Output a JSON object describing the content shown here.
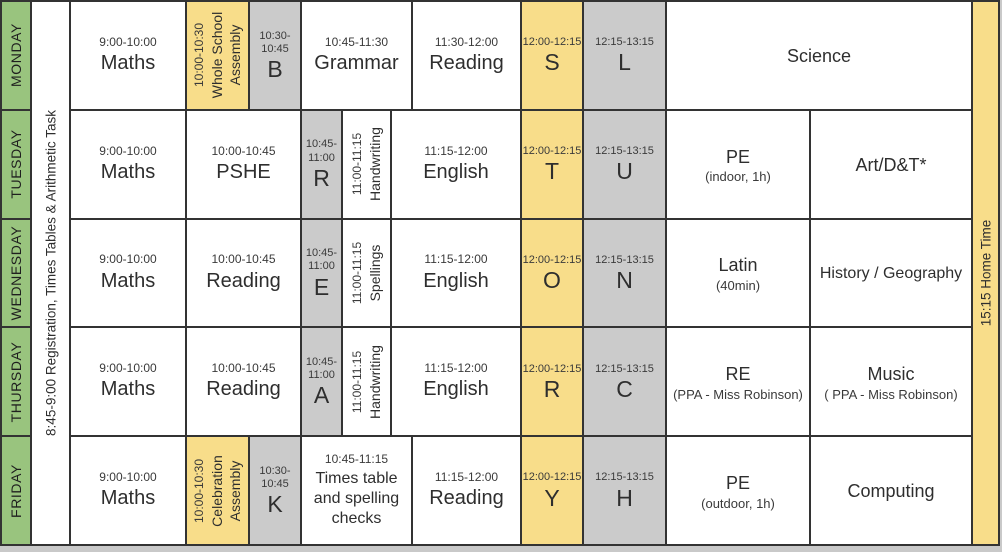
{
  "colors": {
    "green": "#99c47e",
    "yellow": "#f8dd8a",
    "gray": "#cbcbcb",
    "white": "#ffffff",
    "line": "#333333",
    "page_background": "#c9c9c9"
  },
  "registration_label": "8:45-9:00 Registration, Times Tables & Arithmetic Task",
  "home_time_label": "15:15 Home Time",
  "rows": [
    {
      "day": "MONDAY",
      "cells": [
        {
          "type": "std",
          "time": "9:00-10:00",
          "label": "Maths",
          "bg": "white",
          "c": [
            3,
            4
          ]
        },
        {
          "type": "vert",
          "time": "10:00-10:30",
          "label": "Whole School Assembly",
          "lines": [
            "Whole School",
            "Assembly"
          ],
          "bg": "yellow",
          "c": [
            4,
            5
          ]
        },
        {
          "type": "letter",
          "time": "10:30-10:45",
          "label": "B",
          "bg": "gray",
          "c": [
            5,
            6
          ]
        },
        {
          "type": "std",
          "time": "10:45-11:30",
          "label": "Grammar",
          "bg": "white",
          "c": [
            6,
            9
          ]
        },
        {
          "type": "std",
          "time": "11:30-12:00",
          "label": "Reading",
          "bg": "white",
          "c": [
            9,
            10
          ]
        },
        {
          "type": "letter",
          "time": "12:00-12:15",
          "label": "S",
          "bg": "yellow",
          "c": [
            10,
            11
          ]
        },
        {
          "type": "letter",
          "time": "12:15-13:15",
          "label": "L",
          "bg": "gray",
          "c": [
            11,
            12
          ]
        },
        {
          "type": "plain",
          "label": "Science",
          "bg": "white",
          "c": [
            12,
            14
          ]
        }
      ]
    },
    {
      "day": "TUESDAY",
      "cells": [
        {
          "type": "std",
          "time": "9:00-10:00",
          "label": "Maths",
          "bg": "white",
          "c": [
            3,
            4
          ]
        },
        {
          "type": "std",
          "time": "10:00-10:45",
          "label": "PSHE",
          "bg": "white",
          "c": [
            4,
            6
          ]
        },
        {
          "type": "letter",
          "time": "10:45-11:00",
          "label": "R",
          "bg": "gray",
          "c": [
            6,
            7
          ]
        },
        {
          "type": "vert",
          "time": "11:00-11:15",
          "label": "Handwriting",
          "lines": [
            "Handwriting"
          ],
          "bg": "white",
          "c": [
            7,
            8
          ]
        },
        {
          "type": "std",
          "time": "11:15-12:00",
          "label": "English",
          "bg": "white",
          "c": [
            8,
            10
          ]
        },
        {
          "type": "letter",
          "time": "12:00-12:15",
          "label": "T",
          "bg": "yellow",
          "c": [
            10,
            11
          ]
        },
        {
          "type": "letter",
          "time": "12:15-13:15",
          "label": "U",
          "bg": "gray",
          "c": [
            11,
            12
          ]
        },
        {
          "type": "plain",
          "label": "PE",
          "sub": "(indoor, 1h)",
          "bg": "white",
          "c": [
            12,
            13
          ]
        },
        {
          "type": "plain",
          "label": "Art/D&T*",
          "bg": "white",
          "c": [
            13,
            14
          ]
        }
      ]
    },
    {
      "day": "WEDNESDAY",
      "cells": [
        {
          "type": "std",
          "time": "9:00-10:00",
          "label": "Maths",
          "bg": "white",
          "c": [
            3,
            4
          ]
        },
        {
          "type": "std",
          "time": "10:00-10:45",
          "label": "Reading",
          "bg": "white",
          "c": [
            4,
            6
          ]
        },
        {
          "type": "letter",
          "time": "10:45-11:00",
          "label": "E",
          "bg": "gray",
          "c": [
            6,
            7
          ]
        },
        {
          "type": "vert",
          "time": "11:00-11:15",
          "label": "Spellings",
          "lines": [
            "Spellings"
          ],
          "bg": "white",
          "c": [
            7,
            8
          ]
        },
        {
          "type": "std",
          "time": "11:15-12:00",
          "label": "English",
          "bg": "white",
          "c": [
            8,
            10
          ]
        },
        {
          "type": "letter",
          "time": "12:00-12:15",
          "label": "O",
          "bg": "yellow",
          "c": [
            10,
            11
          ]
        },
        {
          "type": "letter",
          "time": "12:15-13:15",
          "label": "N",
          "bg": "gray",
          "c": [
            11,
            12
          ]
        },
        {
          "type": "plain",
          "label": "Latin",
          "sub": "(40min)",
          "bg": "white",
          "c": [
            12,
            13
          ]
        },
        {
          "type": "plain",
          "label": "History / Geography",
          "bg": "white",
          "c": [
            13,
            14
          ]
        }
      ]
    },
    {
      "day": "THURSDAY",
      "cells": [
        {
          "type": "std",
          "time": "9:00-10:00",
          "label": "Maths",
          "bg": "white",
          "c": [
            3,
            4
          ]
        },
        {
          "type": "std",
          "time": "10:00-10:45",
          "label": "Reading",
          "bg": "white",
          "c": [
            4,
            6
          ]
        },
        {
          "type": "letter",
          "time": "10:45-11:00",
          "label": "A",
          "bg": "gray",
          "c": [
            6,
            7
          ]
        },
        {
          "type": "vert",
          "time": "11:00-11:15",
          "label": "Handwriting",
          "lines": [
            "Handwriting"
          ],
          "bg": "white",
          "c": [
            7,
            8
          ]
        },
        {
          "type": "std",
          "time": "11:15-12:00",
          "label": "English",
          "bg": "white",
          "c": [
            8,
            10
          ]
        },
        {
          "type": "letter",
          "time": "12:00-12:15",
          "label": "R",
          "bg": "yellow",
          "c": [
            10,
            11
          ]
        },
        {
          "type": "letter",
          "time": "12:15-13:15",
          "label": "C",
          "bg": "gray",
          "c": [
            11,
            12
          ]
        },
        {
          "type": "plain",
          "label": "RE",
          "sub": "(PPA - Miss Robinson)",
          "bg": "white",
          "c": [
            12,
            13
          ]
        },
        {
          "type": "plain",
          "label": "Music",
          "sub": "( PPA - Miss Robinson)",
          "bg": "white",
          "c": [
            13,
            14
          ]
        }
      ]
    },
    {
      "day": "FRIDAY",
      "cells": [
        {
          "type": "std",
          "time": "9:00-10:00",
          "label": "Maths",
          "bg": "white",
          "c": [
            3,
            4
          ]
        },
        {
          "type": "vert",
          "time": "10:00-10:30",
          "label": "Celebration Assembly",
          "lines": [
            "Celebration",
            "Assembly"
          ],
          "bg": "yellow",
          "c": [
            4,
            5
          ]
        },
        {
          "type": "letter",
          "time": "10:30-10:45",
          "label": "K",
          "bg": "gray",
          "c": [
            5,
            6
          ]
        },
        {
          "type": "std",
          "time": "10:45-11:15",
          "label": "Times table and spelling checks",
          "bg": "white",
          "c": [
            6,
            9
          ]
        },
        {
          "type": "std",
          "time": "11:15-12:00",
          "label": "Reading",
          "bg": "white",
          "c": [
            9,
            10
          ]
        },
        {
          "type": "letter",
          "time": "12:00-12:15",
          "label": "Y",
          "bg": "yellow",
          "c": [
            10,
            11
          ]
        },
        {
          "type": "letter",
          "time": "12:15-13:15",
          "label": "H",
          "bg": "gray",
          "c": [
            11,
            12
          ]
        },
        {
          "type": "plain",
          "label": "PE",
          "sub": "(outdoor, 1h)",
          "bg": "white",
          "c": [
            12,
            13
          ]
        },
        {
          "type": "plain",
          "label": "Computing",
          "bg": "white",
          "c": [
            13,
            14
          ]
        }
      ]
    }
  ]
}
